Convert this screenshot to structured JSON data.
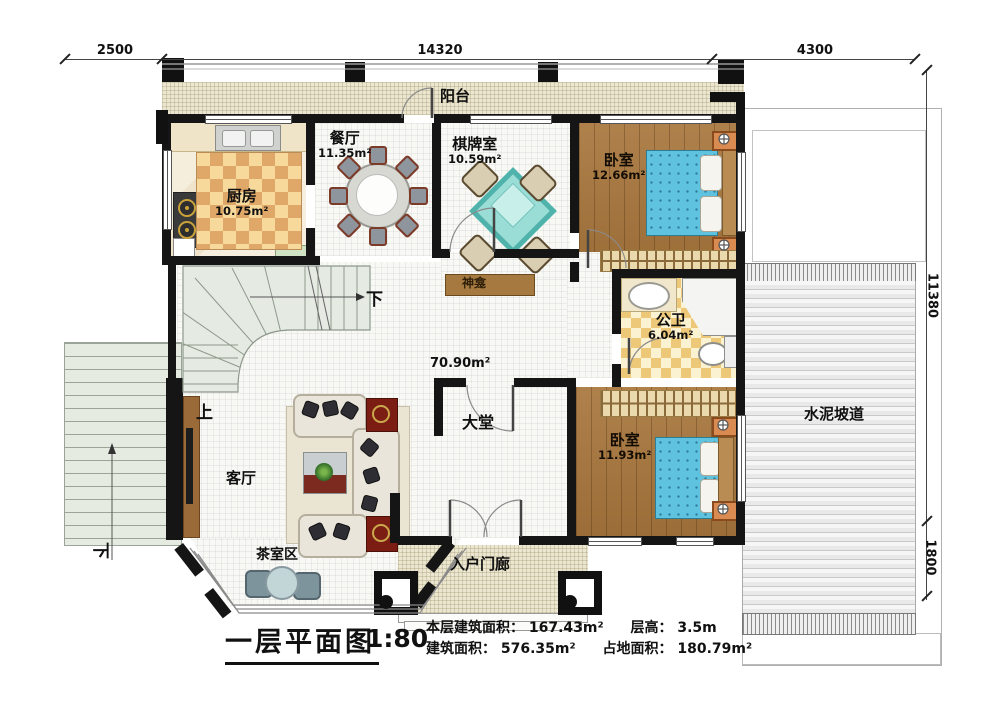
{
  "dims": {
    "top_left": "2500",
    "top_mid": "14320",
    "top_right": "4300",
    "right_upper": "11380",
    "right_lower": "1800"
  },
  "rooms": {
    "balcony": {
      "name": "阳台"
    },
    "dining": {
      "name": "餐厅",
      "area": "11.35m²"
    },
    "kitchen": {
      "name": "厨房",
      "area": "10.75m²"
    },
    "chess": {
      "name": "棋牌室",
      "area": "10.59m²"
    },
    "bedroom1": {
      "name": "卧室",
      "area": "12.66m²"
    },
    "shrine": {
      "name": "神龛"
    },
    "bath": {
      "name": "公卫",
      "area": "6.04m²"
    },
    "hall": {
      "name": "大堂",
      "area": "70.90m²"
    },
    "bedroom2": {
      "name": "卧室",
      "area": "11.93m²"
    },
    "living": {
      "name": "客厅"
    },
    "tea": {
      "name": "茶室区"
    },
    "porch": {
      "name": "入户门廊"
    },
    "ramp": {
      "name": "水泥坡道"
    }
  },
  "stairs": {
    "down_main": "下",
    "up_main": "上",
    "down_left": "下"
  },
  "titleblock": {
    "title": "一层平面图",
    "scale": "1:80",
    "stats": {
      "floor_area_label": "本层建筑面积：",
      "floor_area": "167.43m²",
      "height_label": "层高：",
      "height": "3.5m",
      "build_area_label": "建筑面积：",
      "build_area": "576.35m²",
      "land_area_label": "占地面积：",
      "land_area": "180.79m²"
    }
  }
}
